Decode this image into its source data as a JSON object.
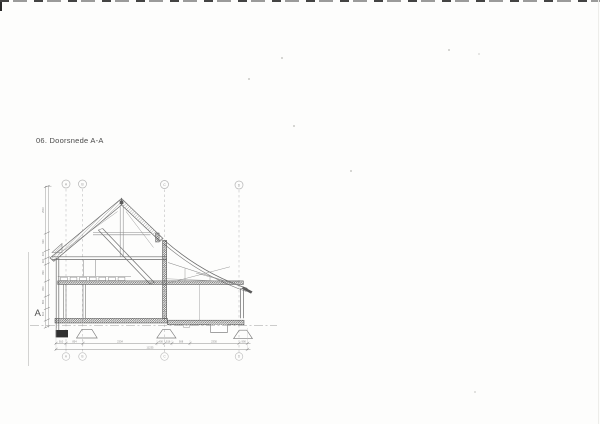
{
  "page": {
    "background": "#fdfdfc",
    "title": "06. Doorsnede A-A",
    "section_marker": "A"
  },
  "grid": {
    "labels_top": [
      "A",
      "B",
      "C",
      "D"
    ],
    "labels_bottom": [
      "A",
      "B",
      "C",
      "D"
    ]
  },
  "dimensions": {
    "horizontal_segments": [
      "910",
      "854",
      "2334",
      "400",
      "516",
      "908",
      "2330",
      "990"
    ],
    "horizontal_total": "11235",
    "vertical_segments": [
      "2510",
      "930",
      "400",
      "300",
      "890",
      "800",
      "660",
      "610"
    ]
  },
  "colors": {
    "line": "#787878",
    "dark_fill": "#545454",
    "grid_line": "#b8b8b8",
    "text": "#4a4a4a",
    "dim_line": "#9a9a9a",
    "foundation_fill": "#303030"
  }
}
